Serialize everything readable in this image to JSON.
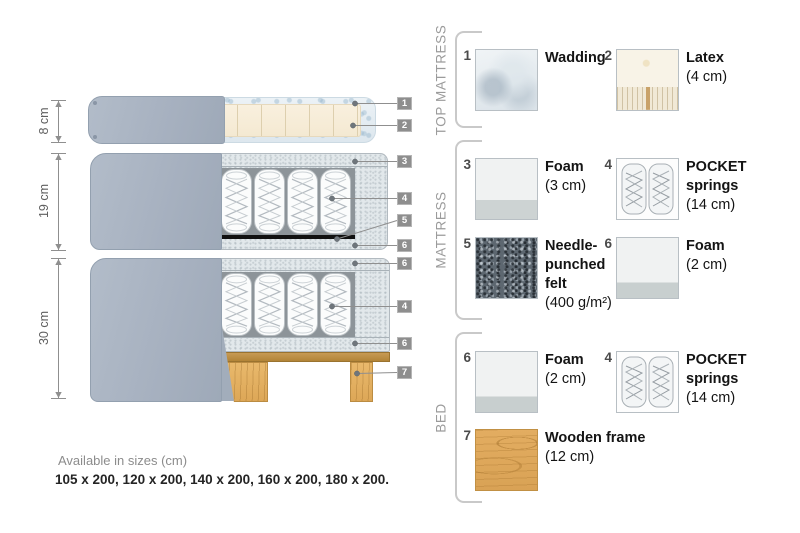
{
  "colors": {
    "fabric_gray": "#a8b2c0",
    "foam_gray": "#e2e8eb",
    "felt_black": "#111111",
    "wood": "#e0aa5e",
    "badge_gray": "#8e8e8e",
    "bracket_gray": "#c9c9c9",
    "wadding_blue": "#dde7ee",
    "latex_cream": "#f7eedd"
  },
  "diagram": {
    "dimensions": [
      {
        "label": "8 cm"
      },
      {
        "label": "19 cm"
      },
      {
        "label": "30 cm"
      }
    ],
    "callouts": [
      {
        "num": "1"
      },
      {
        "num": "2"
      },
      {
        "num": "3"
      },
      {
        "num": "4"
      },
      {
        "num": "5"
      },
      {
        "num": "6"
      },
      {
        "num": "6"
      },
      {
        "num": "4"
      },
      {
        "num": "6"
      },
      {
        "num": "7"
      }
    ]
  },
  "legend": {
    "sections": [
      {
        "title": "TOP MATTRESS",
        "items": [
          {
            "num": "1",
            "name": "Wadding",
            "size": ""
          },
          {
            "num": "2",
            "name": "Latex",
            "size": "(4 cm)"
          }
        ]
      },
      {
        "title": "MATTRESS",
        "items": [
          {
            "num": "3",
            "name": "Foam",
            "size": "(3 cm)"
          },
          {
            "num": "4",
            "name": "POCKET springs",
            "size": "(14 cm)"
          },
          {
            "num": "5",
            "name": "Needle-punched felt",
            "size": "(400 g/m²)"
          },
          {
            "num": "6",
            "name": "Foam",
            "size": "(2 cm)"
          }
        ]
      },
      {
        "title": "BED",
        "items": [
          {
            "num": "6",
            "name": "Foam",
            "size": "(2 cm)"
          },
          {
            "num": "4",
            "name": "POCKET springs",
            "size": "(14 cm)"
          },
          {
            "num": "7",
            "name": "Wooden frame",
            "size": "(12 cm)"
          }
        ]
      }
    ]
  },
  "footer": {
    "sizes_title": "Available in sizes (cm)",
    "sizes_list": "105 x 200, 120 x 200, 140 x 200, 160 x 200, 180 x 200."
  }
}
